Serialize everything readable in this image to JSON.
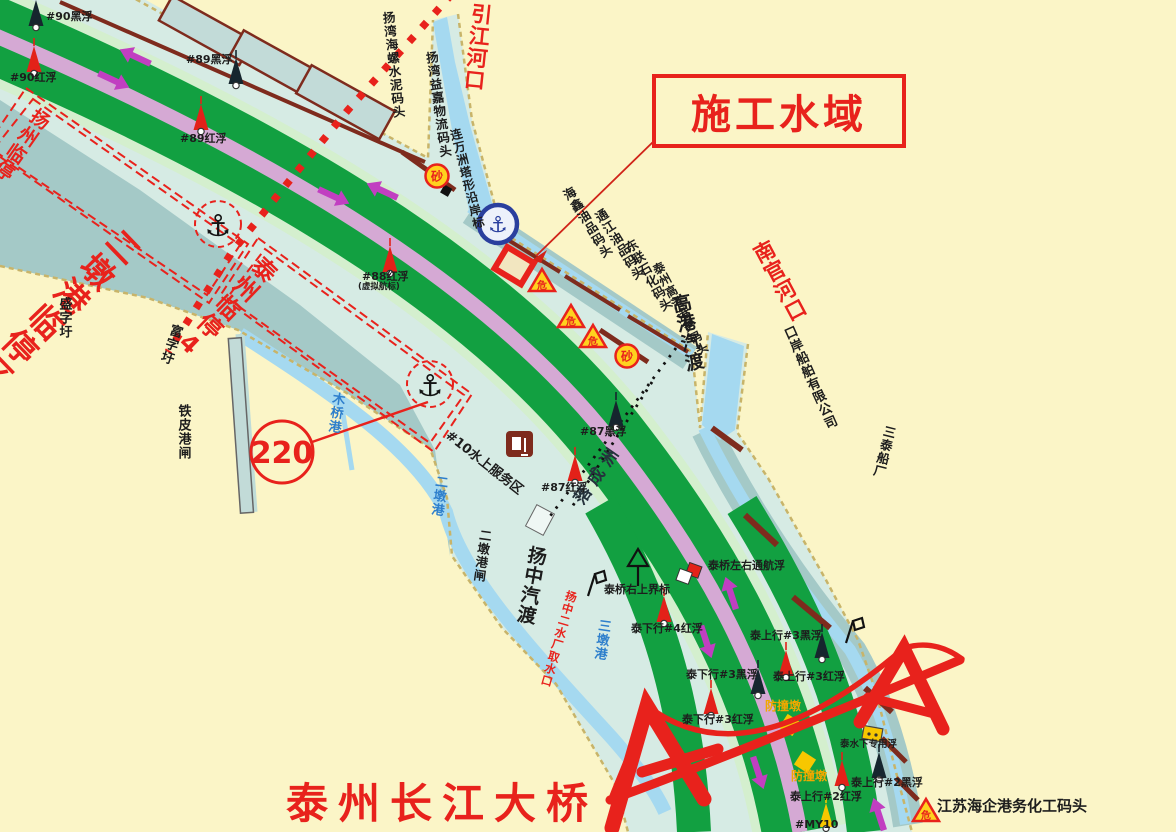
{
  "zones": {
    "yangzhou_linting": "扬州临停1",
    "erdungang_linting": "二墩港临停区",
    "taizhou_linting": "泰州临停4",
    "construction_label": "施工水域",
    "route_badge": "220"
  },
  "waterways": {
    "yinjiang": "引江河口",
    "nanguan": "南官河口",
    "muqiao": "木桥港",
    "erdun": "二墩港",
    "sandun": "三墩港",
    "luochengzhou": "落成洲"
  },
  "shore": {
    "hailuo": "扬湾海螺水泥码头",
    "yijia": "扬湾益嘉物流码头",
    "lianwanzhou": "连万洲塔形沿岸标",
    "haixin": "海鑫油品码头",
    "tongjiang": "通江油品码头",
    "donglian": "东联石化码头",
    "gaogang_wharf": "泰州高港港务码头",
    "gaogang_ferry": "高港汽渡",
    "kouan_shipyard": "口岸船舶有限公司",
    "santai_shipyard": "三泰船厂",
    "haiqi": "江苏海企港务化工码头",
    "shengzi": "盛字圩",
    "fuzi": "富字圩",
    "tiepi": "铁皮港闸",
    "erdun_zha": "二墩港闸",
    "yangzhong_ferry": "扬中汽渡",
    "qushuikou": "扬中二水厂取水口"
  },
  "buoys": {
    "b90_black": "#90黑浮",
    "b90_red": "#90红浮",
    "b89_black": "#89黑浮",
    "b89_red": "#89红浮",
    "b88_red": "#88红浮",
    "b88_note": "(虚拟航标)",
    "b87_black": "#87黑浮",
    "b87_red": "#87红浮",
    "service_area": "#10水上服务区",
    "qiao_right_mark": "泰桥右上界标",
    "qiao_nav_buoy": "泰桥左右通航浮",
    "tx4_red": "泰下行#4红浮",
    "tx3_black": "泰下行#3黑浮",
    "tx3_red": "泰下行#3红浮",
    "ts3_black": "泰上行#3黑浮",
    "ts3_red": "泰上行#3红浮",
    "ts2_black": "泰上行#2黑浮",
    "ts2_red": "泰上行#2红浮",
    "special": "泰水下专用浮",
    "my10": "#MY10"
  },
  "bridge": {
    "name": "泰州长江大桥",
    "pier_label": "防撞墩"
  },
  "markers": {
    "sha": "砂",
    "wei": "危",
    "anchor": "⚓"
  },
  "colors": {
    "accent_red": "#E8221C",
    "channel_green": "#12A041",
    "separator_pink": "#D5A9D4",
    "shallow_blue": "#A5D9F0",
    "anchorage_teal": "#A4C9C7",
    "land_cream": "#FBF5C7",
    "dock_maroon": "#7E2B1D",
    "hazard_yellow": "#FFD21E",
    "arrow_magenta": "#C13FC1",
    "creek_label_blue": "#2E7FCC"
  }
}
